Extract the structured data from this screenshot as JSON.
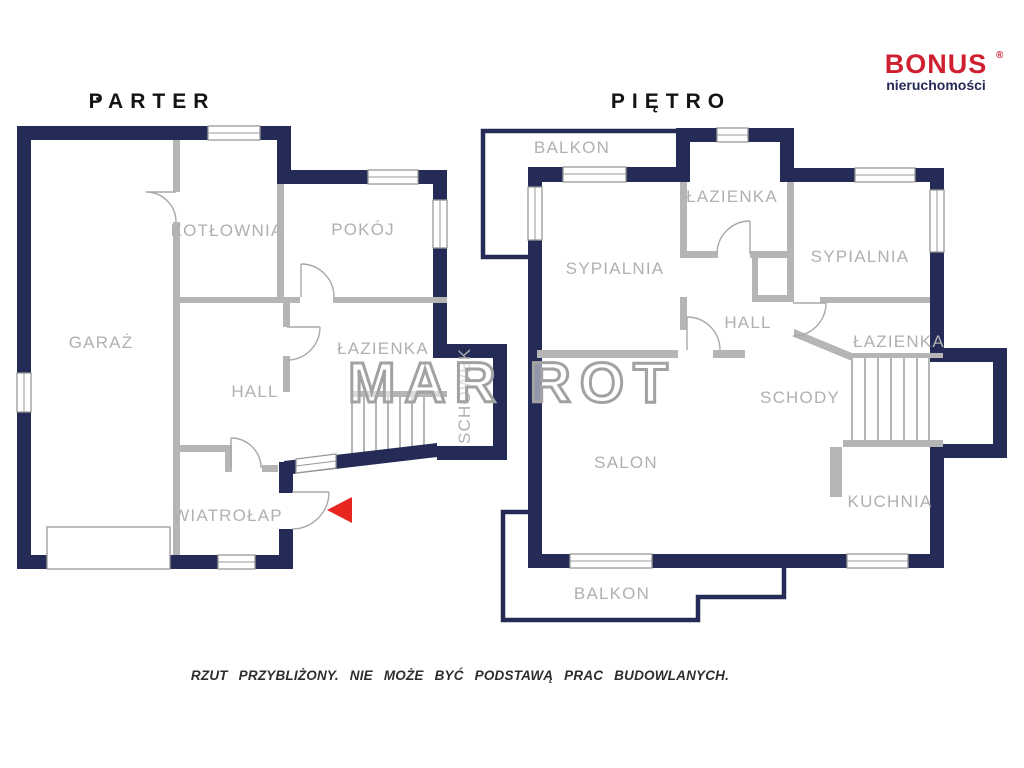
{
  "logo": {
    "brand": "BONUS",
    "registered": "®",
    "subtitle": "nieruchomości"
  },
  "titles": {
    "parter_dot": "·",
    "parter": "PARTER",
    "pietro": "PIĘTRO"
  },
  "parter_rooms": {
    "kotlownia": "KOTŁOWNIA",
    "pokoj": "POKÓJ",
    "garaz": "GARAŻ",
    "lazienka": "ŁAZIENKA",
    "hall": "HALL",
    "schowek": "SCHOWEK",
    "wiatrolap": "WIATROŁAP"
  },
  "pietro_rooms": {
    "balkon_top": "BALKON",
    "lazienka_top": "ŁAZIENKA",
    "sypialnia_left": "SYPIALNIA",
    "sypialnia_right": "SYPIALNIA",
    "hall": "HALL",
    "lazienka_right": "ŁAZIENKA",
    "schody": "SCHODY",
    "salon": "SALON",
    "kuchnia": "KUCHNIA",
    "balkon_bottom": "BALKON"
  },
  "watermark": "MAR ROT",
  "disclaimer": "RZUT PRZYBLIŻONY. NIE MOŻE BYĆ PODSTAWĄ PRAC BUDOWLANYCH.",
  "colors": {
    "wall": "#252b57",
    "interior_wall": "#b5b5b5",
    "label": "#b0b0b0",
    "entrance_arrow": "#e8251f",
    "logo_red": "#cf2030"
  }
}
